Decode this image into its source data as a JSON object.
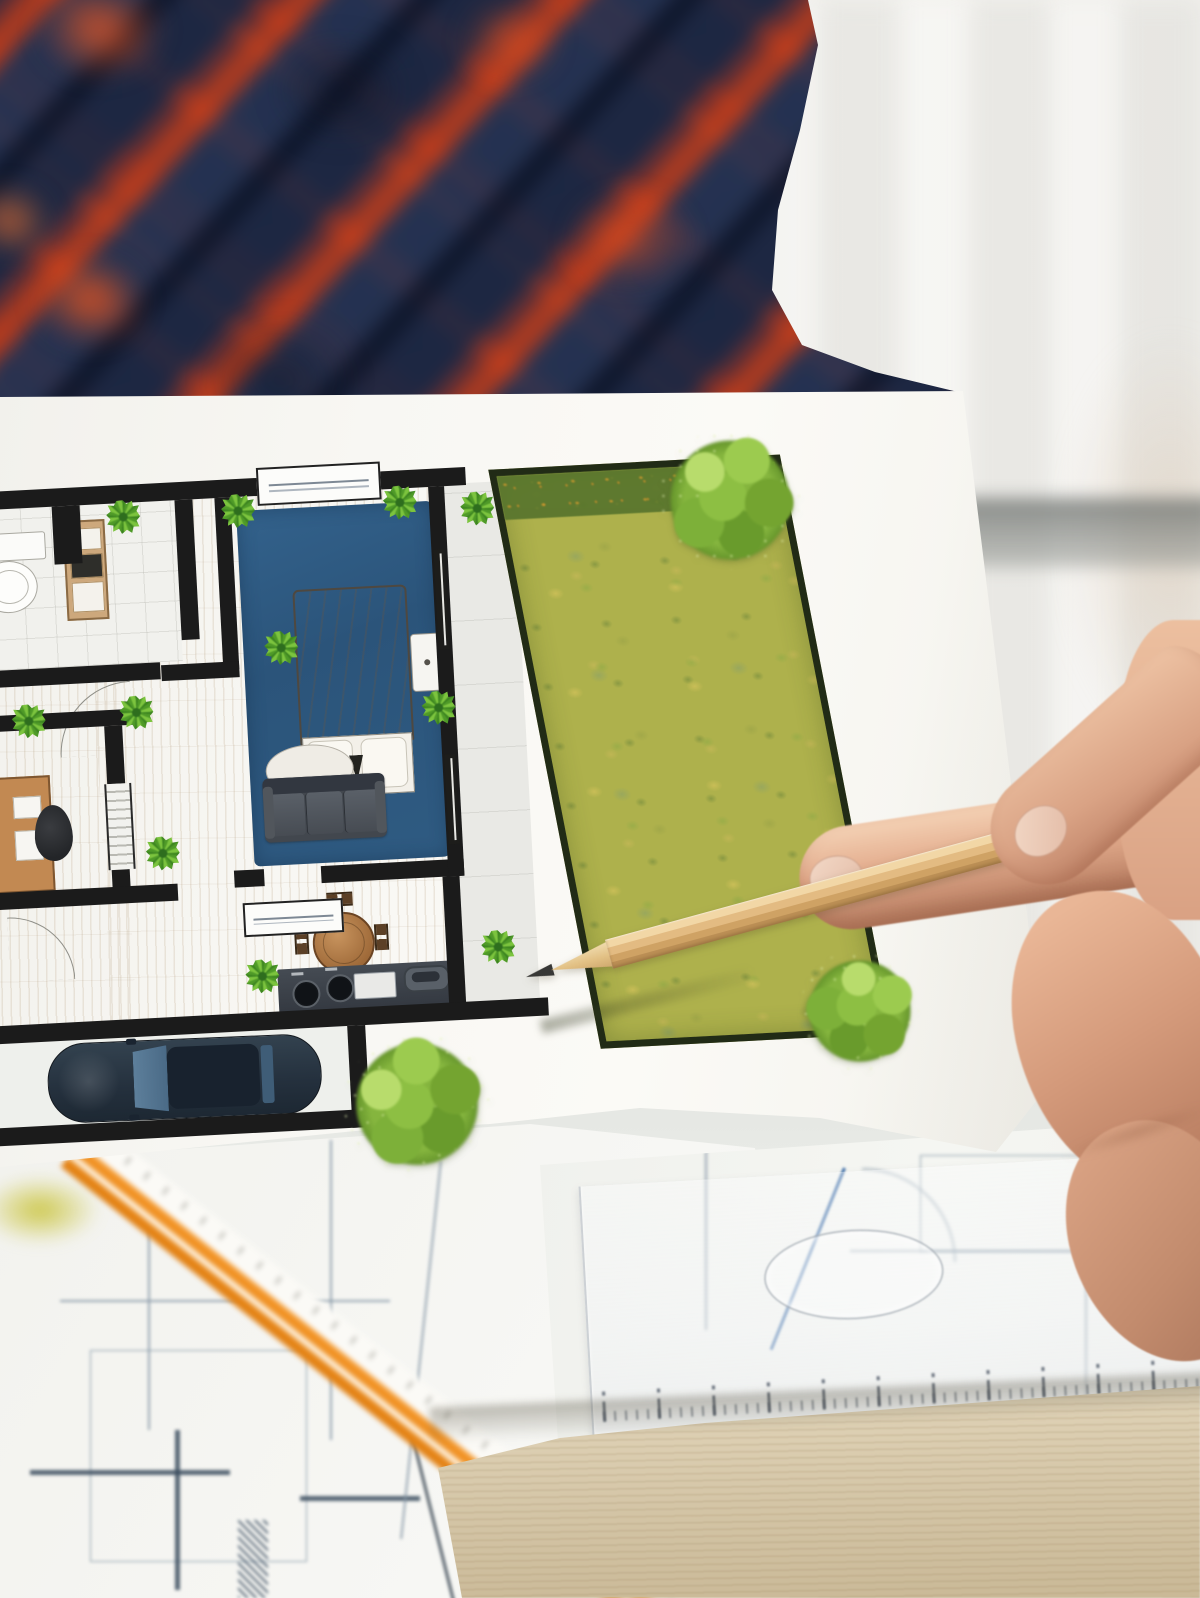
{
  "labels": {
    "scene": "Person in plaid shirt holding a colored floor plan and pointing at the garden area with a wooden pencil over a desk of blueprints",
    "shirt": "blurred red and navy plaid flannel shirt",
    "wall": "blurred bright interior wall background",
    "held_paper": "white sheet with colored architectural floor plan",
    "floor_plan": "top-view colored floor plan of a house with garden",
    "bathroom": "bathroom with toilet and shelf",
    "bedroom": "bedroom with blue rug, double bed, pillows and nightstand",
    "living_room": "living room with gray sofa, oval rug and round dining table",
    "office": "study room with desk and office chair",
    "kitchen": "kitchen counter with two burners, sink and handle",
    "garage": "garage with dark blue car seen from above",
    "patio": "paved patio strip between house and lawn",
    "garden": "yellow-green model lawn with dark border and fluffy model trees",
    "pencil": "sharpened wooden pencil pointing at the lawn",
    "hand": "right hand holding the pencil between thumb and index finger",
    "desk": "light wooden desk with blueprint sheets, orange scale ruler and transparent template ruler"
  },
  "palette": {
    "plaid_navy": "#26324e",
    "plaid_orange": "#e8481f",
    "paper_white": "#f8f7f3",
    "wood_floor": "#ead9bf",
    "rug_blue": "#2f5b80",
    "bed_blanket": "#b29a7f",
    "lawn_green": "#aeb14c",
    "tree_green": "#7fb13b",
    "wall_black": "#1b1b1b",
    "sofa_gray": "#42474e",
    "table_wood": "#b0764a",
    "car_navy": "#24303d",
    "pencil_wood": "#e3bb82",
    "skin_tone": "#dca98b",
    "desk_wood": "#d8c9a8",
    "ruler_orange": "#ec8c1e",
    "blueprint_line": "#8496a6"
  }
}
